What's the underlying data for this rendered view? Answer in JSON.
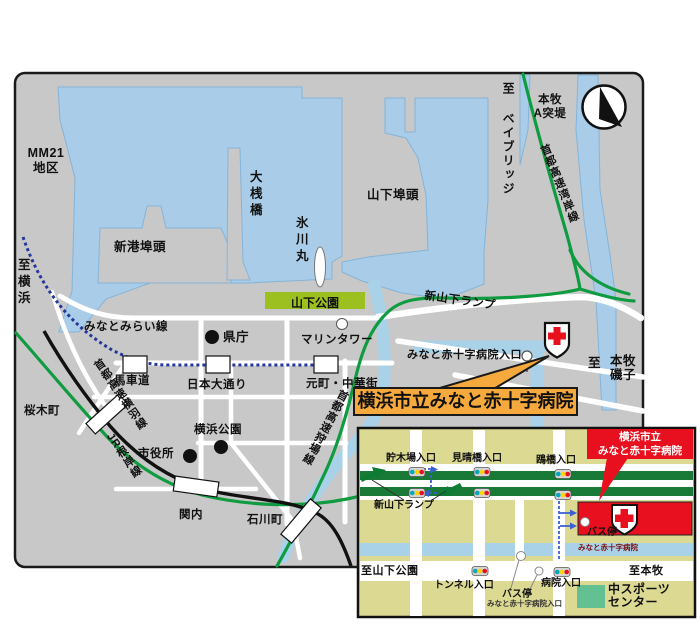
{
  "main_map": {
    "labels": {
      "mm21_l1": "MM21",
      "mm21_l2": "地区",
      "to_yokohama": "至横浜",
      "shinko_pier": "新港埠頭",
      "osanbashi": "大桟橋",
      "hikawamaru": "氷川丸",
      "yamashita_pier": "山下埠頭",
      "yamashita_park": "山下公園",
      "to_baybridge": "至 ベイブリッジ",
      "honmoku_a_l1": "本牧",
      "honmoku_a_l2": "A突堤",
      "wangan_expwy": "首都高速湾岸線",
      "minatomirai_line": "みなとみらい線",
      "marine_tower": "マリンタワー",
      "kencho": "県庁",
      "bashamichi": "馬車道",
      "nihon_odori": "日本大通り",
      "motomachi_chukagai": "元町・中華街",
      "yokohane_expwy": "首都高速横羽線",
      "jr_negishi_line": "JR根岸線",
      "sakuragicho": "桜木町",
      "shiyakusho": "市役所",
      "yokohama_park": "横浜公園",
      "kannai": "関内",
      "ishikawacho": "石川町",
      "kariba_expwy": "首都高速狩場線",
      "shin_yamashita_ramp": "新山下ランプ",
      "hospital_entrance": "みなと赤十字病院入口",
      "to_prefix": "至",
      "to_honmoku": "本牧",
      "to_isogo": "磯子",
      "hospital_callout": "横浜市立みなと赤十字病院"
    }
  },
  "inset": {
    "labels": {
      "chobokuba_iriguchi": "貯木場入口",
      "miharashibashi_iriguchi": "見晴橋入口",
      "kamomebashi_iriguchi": "鴎橋入口",
      "shin_yamashita_ramp": "新山下ランプ",
      "tunnel_iriguchi": "トンネル入口",
      "byoin_iriguchi": "病院入口",
      "bus_stop_hospital": "バス停",
      "bus_stop_hospital_sub": "みなと赤十字病院",
      "bus_stop_entrance": "バス停",
      "bus_stop_entrance_sub": "みなと赤十字病院入口",
      "to_yamashita_park": "至山下公園",
      "to_honmoku": "至本牧",
      "sports_center_l1": "中スポーツ",
      "sports_center_l2": "センター",
      "callout_l1": "横浜市立",
      "callout_l2": "みなと赤十字病院"
    }
  },
  "colors": {
    "land": "#c8c8c8",
    "water": "#a9cde8",
    "highway_green": "#0f9b3f",
    "park_green": "#9dc021",
    "rail_black": "#111111",
    "minatomirai_blue": "#26379b",
    "callout_orange": "#f6a93c",
    "red_cross_red": "#e8101e",
    "inset_bg": "#dcd993",
    "inset_road_green": "#187a36",
    "canal_blue": "#a9d2e8",
    "sports_green": "#62c093",
    "route_blue": "#3a5fd0"
  }
}
